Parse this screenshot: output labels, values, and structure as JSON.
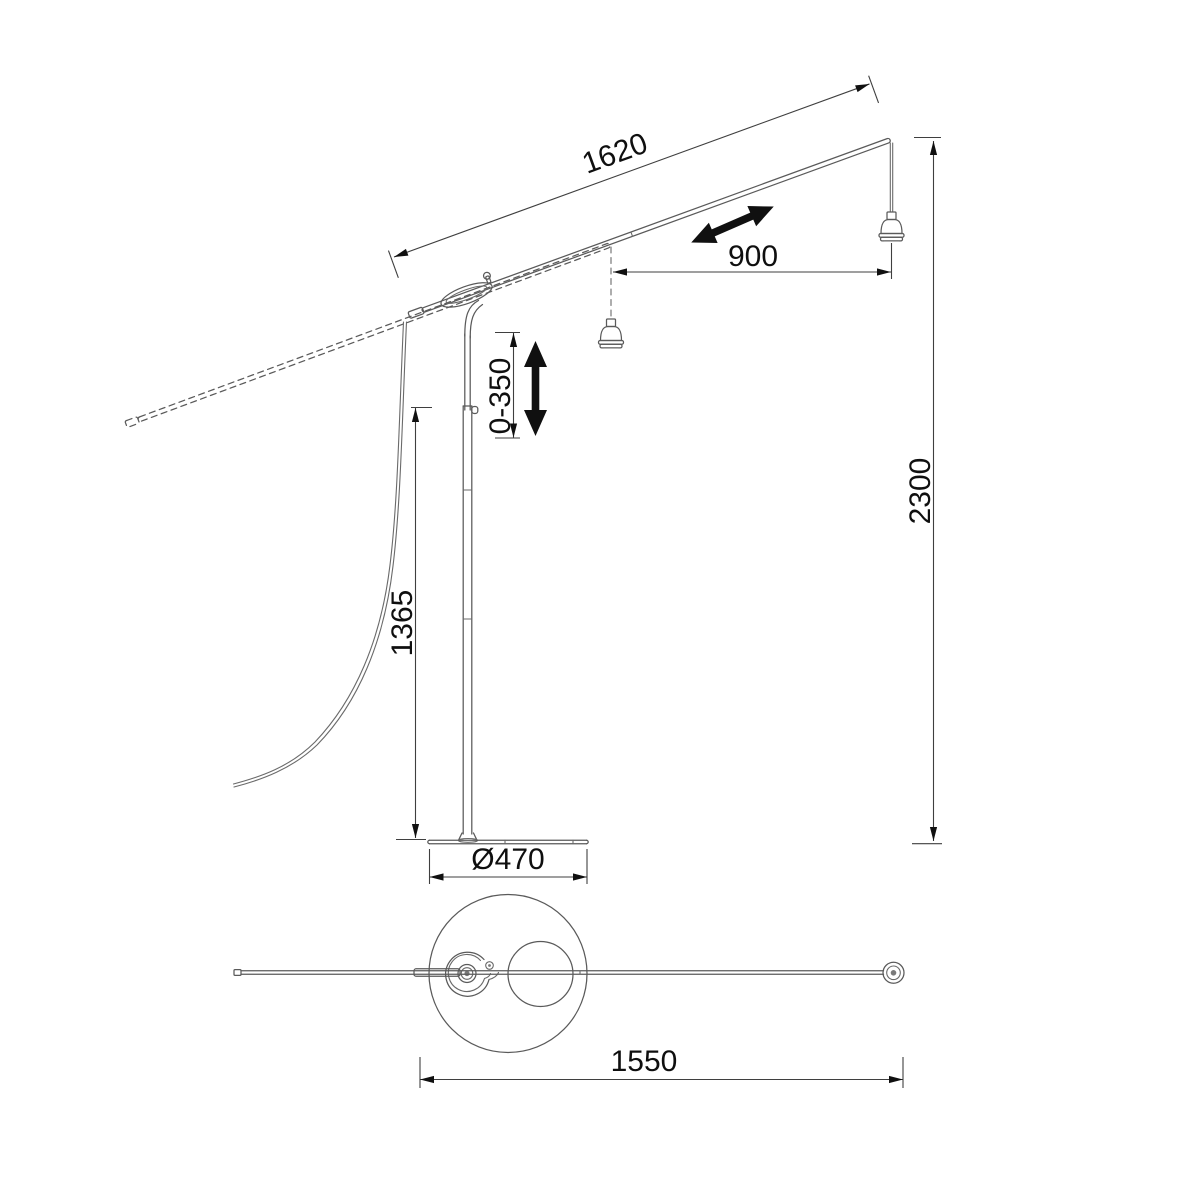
{
  "drawing": {
    "dimensions": {
      "arm_length": "1620",
      "slide_travel": "900",
      "drop_adjustment": "0-350",
      "overall_height": "2300",
      "stand_height": "1365",
      "base_diameter": "Ø470",
      "overall_width": "1550"
    },
    "colors": {
      "line": "#5a5a5a",
      "dimension_line": "#3f3f3f",
      "text": "#0f0f0f",
      "arrow_fill": "#101010",
      "background": "#ffffff"
    }
  }
}
